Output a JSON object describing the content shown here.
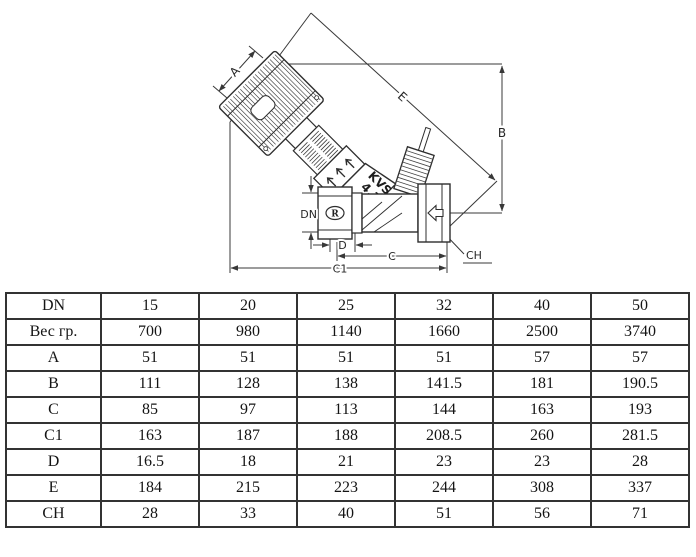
{
  "diagram": {
    "labels": {
      "A": "A",
      "B": "B",
      "E": "E",
      "DN": "DN",
      "D": "D",
      "C": "C",
      "C1": "C1",
      "CH": "CH"
    },
    "body_marking_line1": "KVS",
    "body_marking_line2": "4,1",
    "port_logo": "R",
    "line_color": "#383838"
  },
  "table": {
    "rows": [
      {
        "label": "DN",
        "values": [
          "15",
          "20",
          "25",
          "32",
          "40",
          "50"
        ]
      },
      {
        "label": "Вес гр.",
        "values": [
          "700",
          "980",
          "1140",
          "1660",
          "2500",
          "3740"
        ]
      },
      {
        "label": "A",
        "values": [
          "51",
          "51",
          "51",
          "51",
          "57",
          "57"
        ]
      },
      {
        "label": "B",
        "values": [
          "111",
          "128",
          "138",
          "141.5",
          "181",
          "190.5"
        ]
      },
      {
        "label": "C",
        "values": [
          "85",
          "97",
          "113",
          "144",
          "163",
          "193"
        ]
      },
      {
        "label": "C1",
        "values": [
          "163",
          "187",
          "188",
          "208.5",
          "260",
          "281.5"
        ]
      },
      {
        "label": "D",
        "values": [
          "16.5",
          "18",
          "21",
          "23",
          "23",
          "28"
        ]
      },
      {
        "label": "E",
        "values": [
          "184",
          "215",
          "223",
          "244",
          "308",
          "337"
        ]
      },
      {
        "label": "CH",
        "values": [
          "28",
          "33",
          "40",
          "51",
          "56",
          "71"
        ]
      }
    ]
  }
}
